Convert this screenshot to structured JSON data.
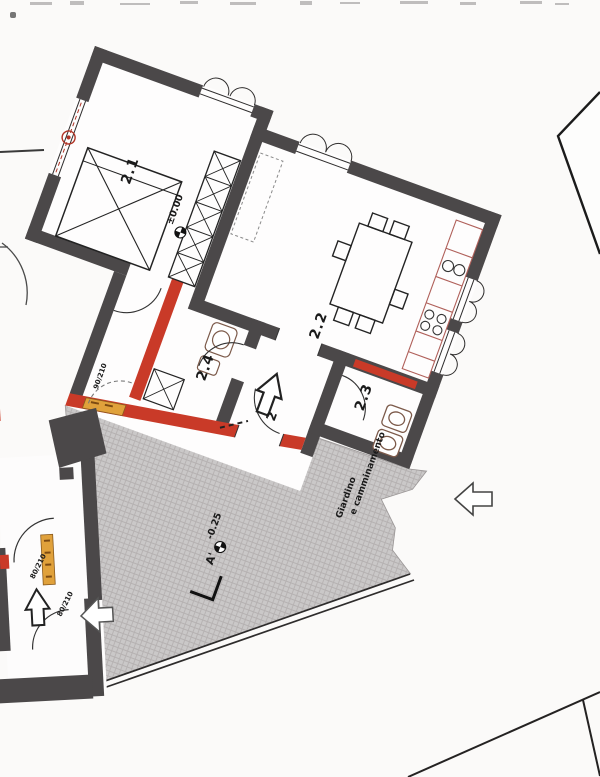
{
  "plan": {
    "rooms": [
      {
        "label": "2.1"
      },
      {
        "label": "2.2"
      },
      {
        "label": "2.3"
      },
      {
        "label": "2.4"
      }
    ],
    "levels": {
      "interior": "±0.00",
      "garden": "-0.25"
    },
    "entrance": {
      "label": "2"
    },
    "section": {
      "label": "A'"
    },
    "garden": {
      "line1": "Giardino",
      "line2": "e camminamento"
    },
    "doors": {
      "hall": "90/210",
      "annex_a": "80/210",
      "annex_b": "80/210"
    },
    "colors": {
      "wall": "#4b4849",
      "new_wall_red": "#c93a28",
      "demolition_yellow": "#e0a13b",
      "garden_gray": "#cac8c8"
    }
  }
}
